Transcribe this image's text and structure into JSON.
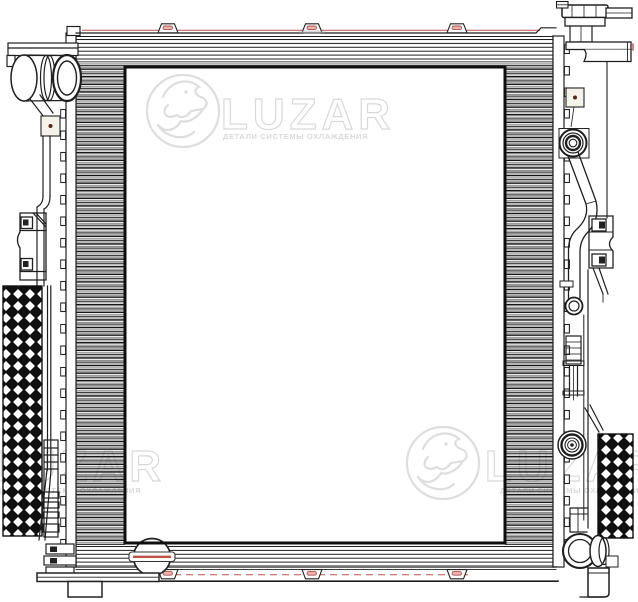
{
  "watermark": {
    "title": "LUZAR",
    "subtitle": "ДЕТАЛИ СИСТЕМЫ ОХЛАЖДЕНИЯ"
  },
  "colors": {
    "ink": "#1f1f1f",
    "accent_red": "#c0504a",
    "accent_pink": "#eab3ad",
    "watermark_gray": "#d9d9d9",
    "sensor_fill": "#f4f3ea",
    "paper": "#ffffff"
  }
}
